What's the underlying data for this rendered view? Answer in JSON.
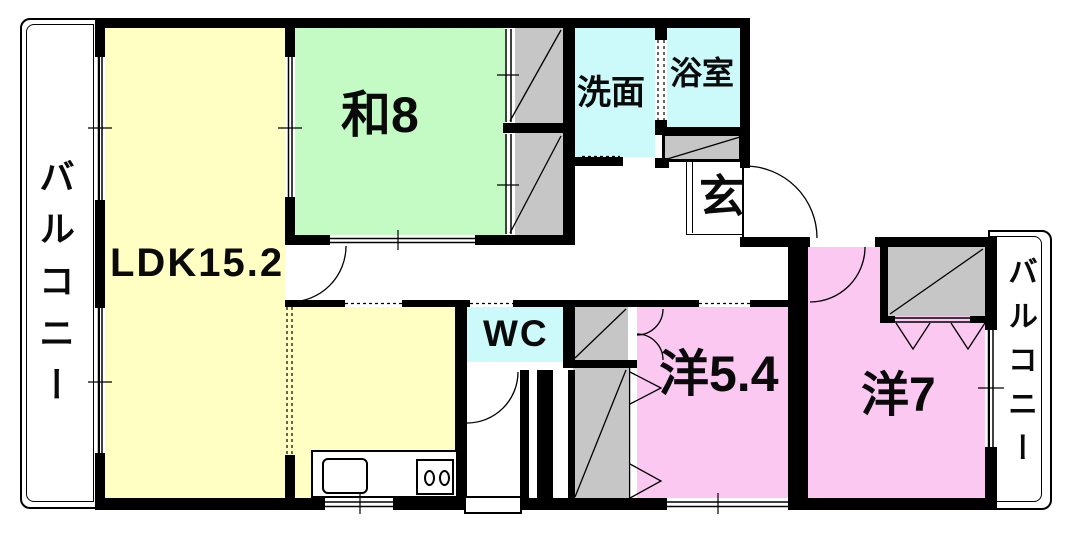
{
  "floorplan": {
    "balcony_left": {
      "label": "バルコニー"
    },
    "balcony_right": {
      "label": "バルコニー"
    },
    "rooms": {
      "ldk": {
        "label": "LDK15.2"
      },
      "washitsu": {
        "label": "和8"
      },
      "senmen": {
        "label": "洗面"
      },
      "yokushitsu": {
        "label": "浴室"
      },
      "genkan": {
        "label": "玄"
      },
      "wc": {
        "label": "WC"
      },
      "western_54": {
        "label": "洋5.4"
      },
      "western_7": {
        "label": "洋7"
      }
    },
    "colors": {
      "wall": "#000000",
      "background": "#FFFFFF",
      "ldk_fill": "#FFFFC4",
      "tatami_fill": "#C4FAC4",
      "wet_area_fill": "#CCFAFA",
      "western_room_fill": "#FBC8F2",
      "closet_fill": "#C6C6C6"
    }
  }
}
